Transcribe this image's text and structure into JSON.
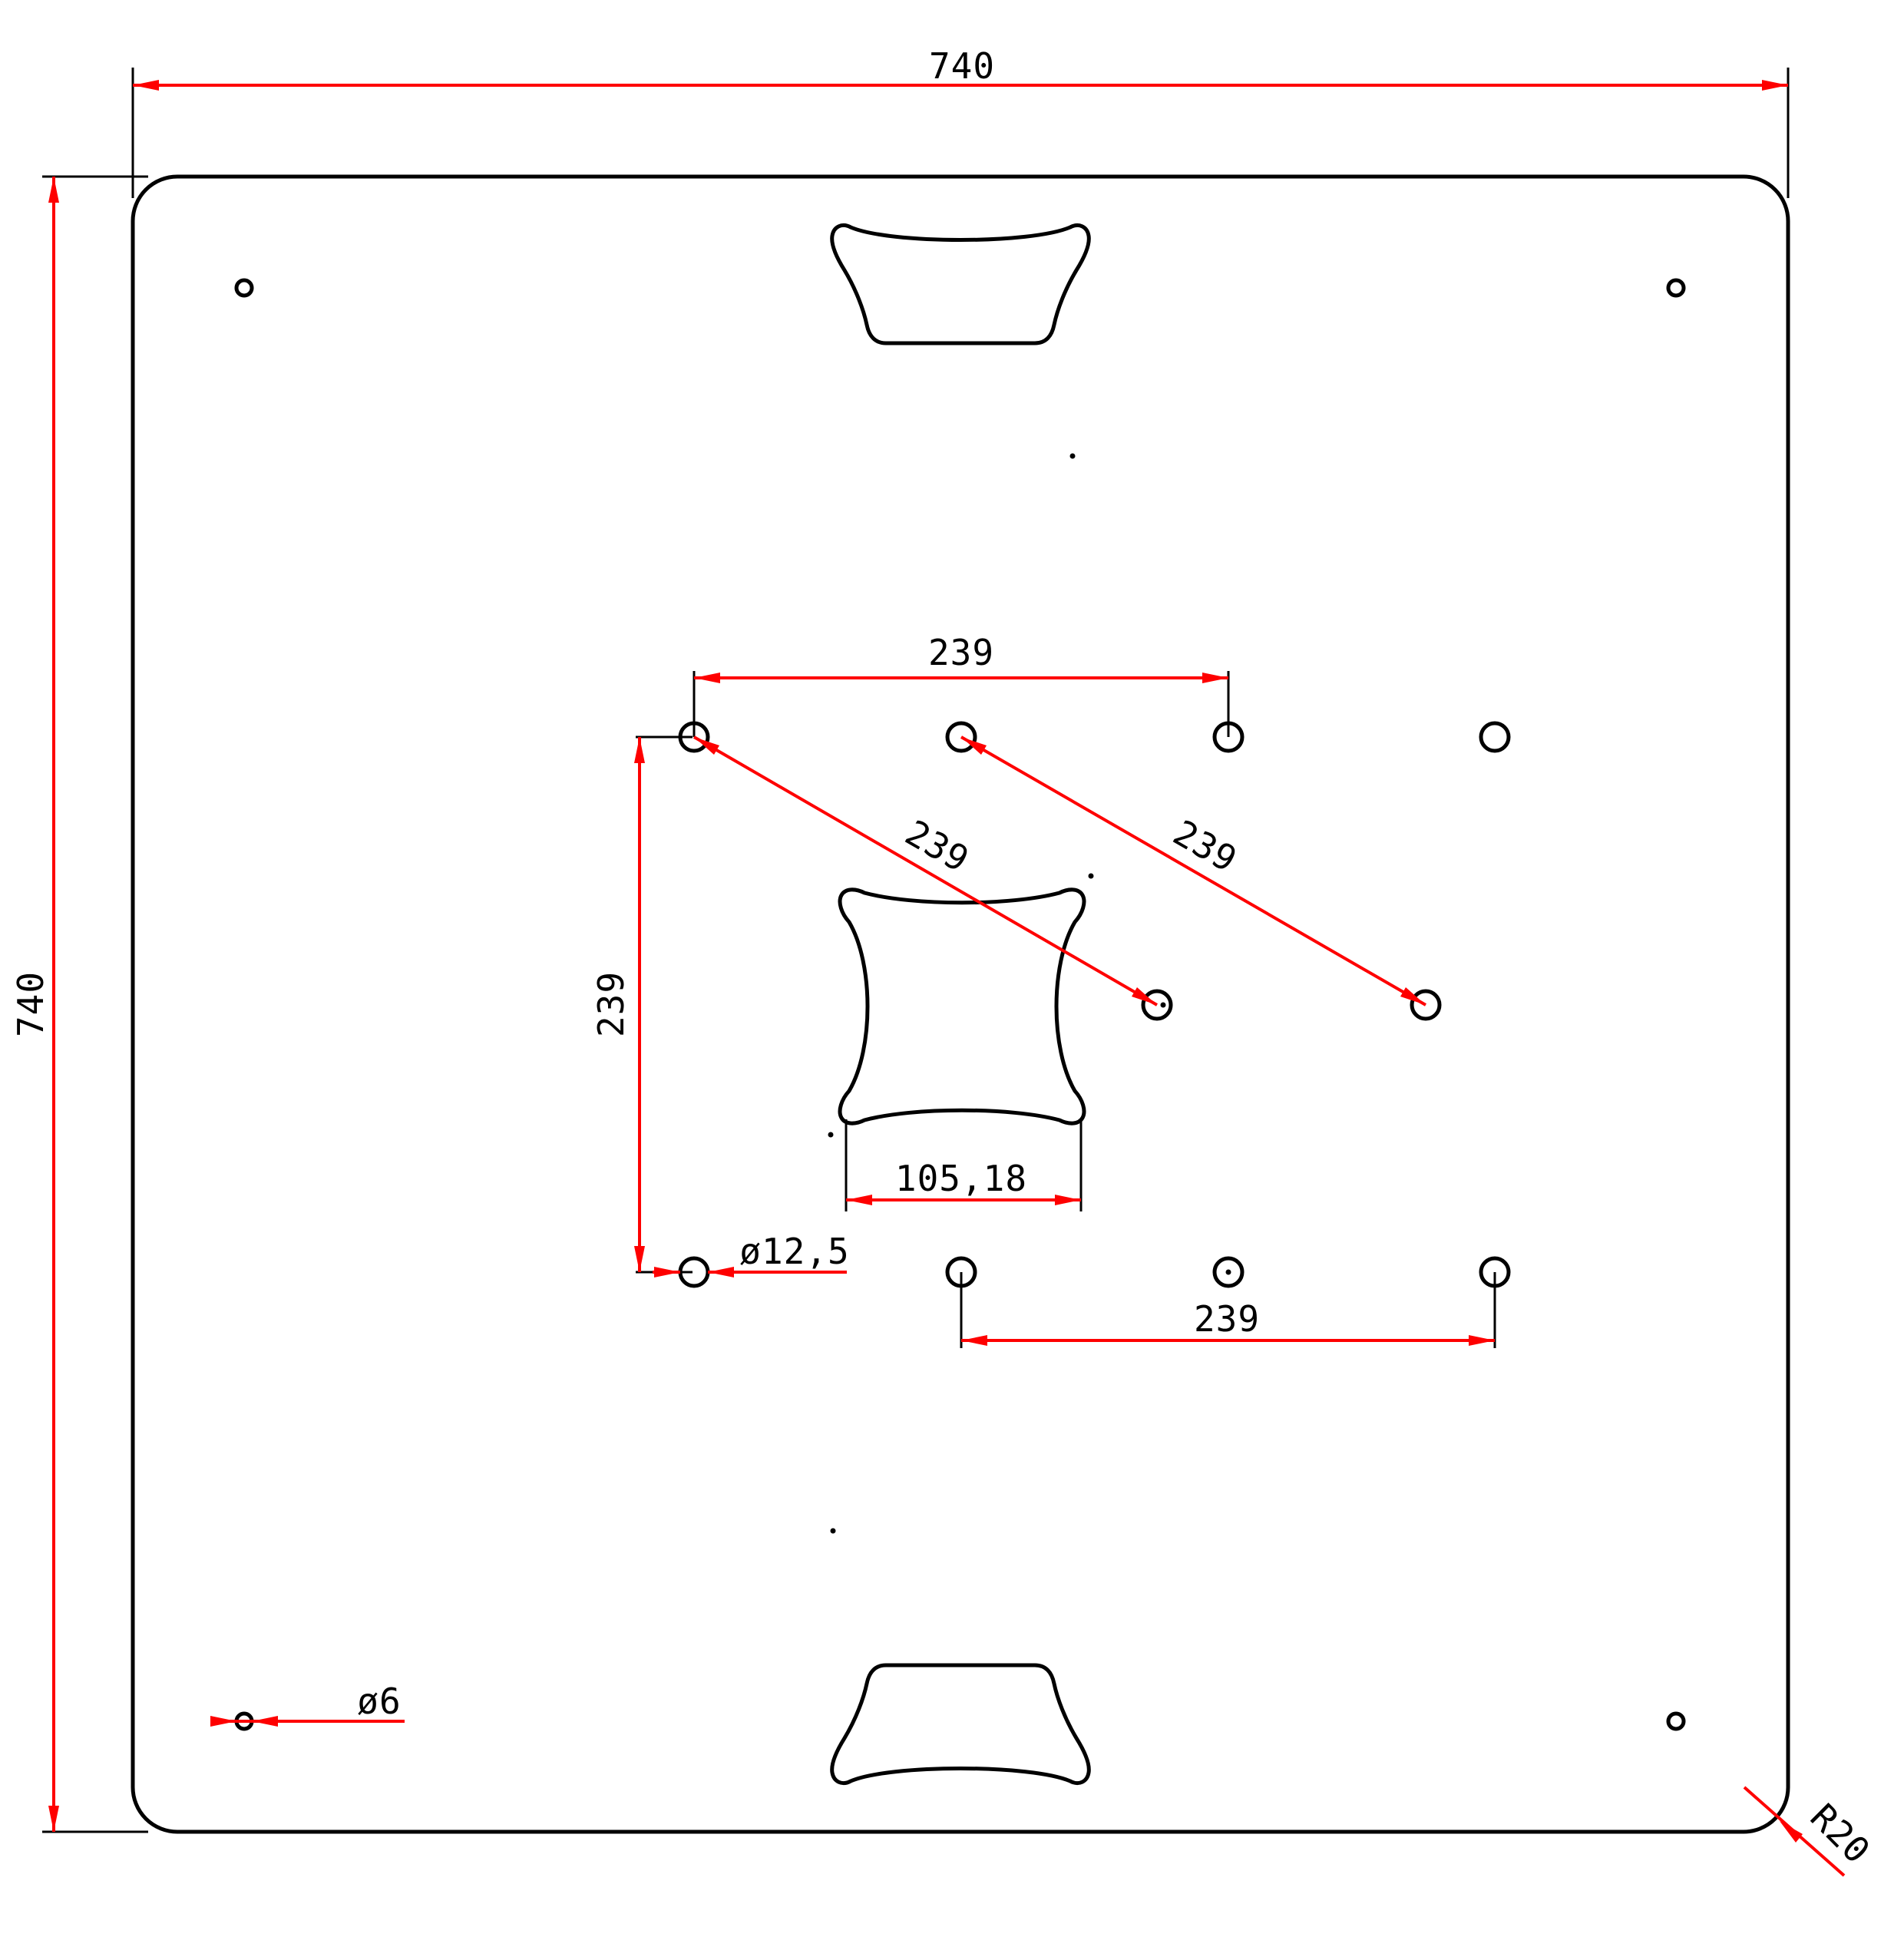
{
  "drawing": {
    "description": "Square base plate engineering drawing, top view",
    "dimensions": {
      "plate_width": "740",
      "plate_height": "740",
      "top_hole_spacing": "239",
      "bottom_hole_spacing": "239",
      "left_hole_spacing": "239",
      "diagonal_hole_spacing_left": "239",
      "diagonal_hole_spacing_right": "239",
      "center_cutout_width": "105,18",
      "pattern_hole_diameter": "ø12,5",
      "corner_hole_diameter": "ø6",
      "corner_radius": "R20"
    },
    "colors": {
      "dimension_lines": "#fe0000",
      "geometry_lines": "#000000",
      "background": "#ffffff"
    }
  }
}
